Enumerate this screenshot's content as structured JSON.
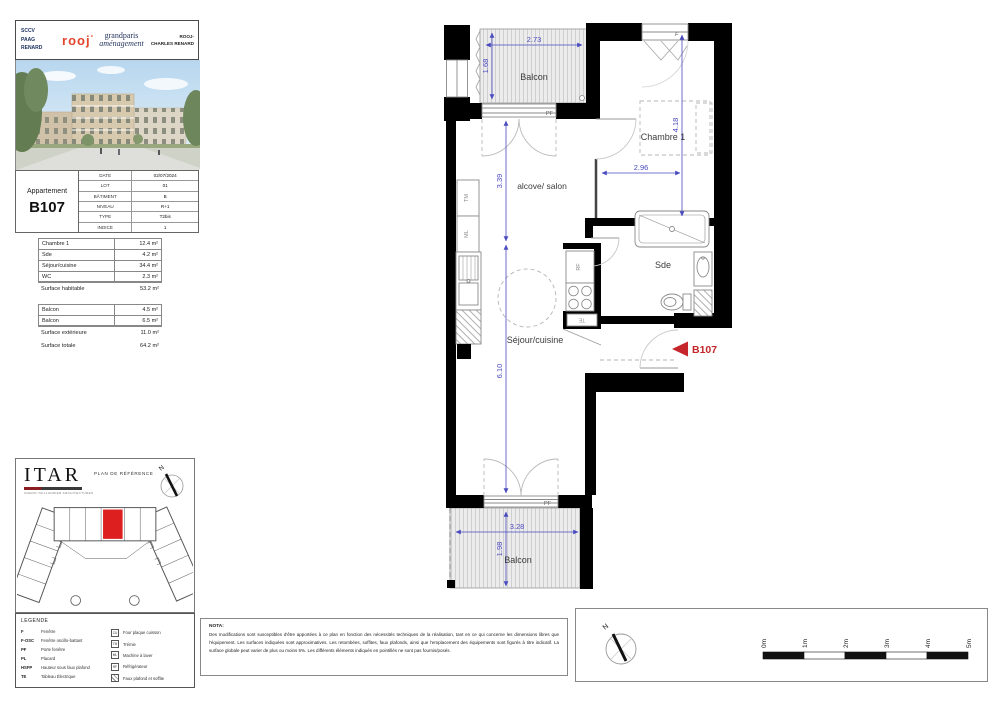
{
  "header": {
    "owner": [
      "SCCV",
      "PAAG",
      "RENARD"
    ],
    "logo_rooj": "rooj",
    "logo_grandparis": [
      "grandparis",
      "aménagement"
    ],
    "project": [
      "ROOJ-",
      "CHARLES RENARD"
    ]
  },
  "apartment": {
    "label": "Appartement",
    "number": "B107",
    "info": [
      {
        "key": "DATE",
        "value": "02/07/2024"
      },
      {
        "key": "LOT",
        "value": "01"
      },
      {
        "key": "BÂTIMENT",
        "value": "B"
      },
      {
        "key": "NIVEAU",
        "value": "R+1"
      },
      {
        "key": "TYPE",
        "value": "T2bis"
      },
      {
        "key": "INDICE",
        "value": "1"
      }
    ]
  },
  "surfaces": {
    "rooms": [
      {
        "name": "Chambre 1",
        "area": "12.4 m²"
      },
      {
        "name": "Sde",
        "area": "4.2 m²"
      },
      {
        "name": "Séjour/cuisine",
        "area": "34.4 m²"
      },
      {
        "name": "WC",
        "area": "2.3 m²"
      }
    ],
    "habitable": {
      "name": "Surface habitable",
      "area": "53.2 m²"
    },
    "exterior_rooms": [
      {
        "name": "Balcon",
        "area": "4.5 m²"
      },
      {
        "name": "Balcon",
        "area": "6.5 m²"
      }
    ],
    "exterior_total": {
      "name": "Surface extérieure",
      "area": "11.0 m²"
    },
    "total": {
      "name": "Surface totale",
      "area": "64.2 m²"
    }
  },
  "architect": {
    "name": "ITAR",
    "subtitle": "INGRID TAILLANDIER ARCHITECTURES",
    "plan_label": "PLAN DE RÉFÉRENCE",
    "north_label": "N"
  },
  "legend": {
    "title": "LEGENDE",
    "abbreviations": [
      {
        "abbr": "F",
        "label": "Fenêtre"
      },
      {
        "abbr": "F-OSC",
        "label": "Fenêtre oscillo-battant"
      },
      {
        "abbr": "PF",
        "label": "Porte fenêtre"
      },
      {
        "abbr": "PL",
        "label": "Placard"
      },
      {
        "abbr": "HSFP",
        "label": "Hauteur sous faux plafond"
      },
      {
        "abbr": "TE",
        "label": "Tableau Électrique"
      }
    ],
    "symbols": [
      {
        "abbr": "CU",
        "label": "Four plaque cuisson"
      },
      {
        "abbr": "TM",
        "label": "Trémie"
      },
      {
        "abbr": "ML",
        "label": "Machine à laver"
      },
      {
        "abbr": "RF",
        "label": "Réfrigérateur"
      }
    ],
    "symbol_hatch": {
      "label": "Faux plafond et soffite"
    }
  },
  "nota": {
    "title": "NOTA:",
    "text": "Des modifications sont susceptibles d'être apportées à ce plan en fonction des nécessités techniques de la réalisation, tant en ce qui concerne les dimensions libres que l'équipement. Les surfaces indiquées sont approximatives. Les retombées, soffites, faux plafonds, ainsi que l'emplacement des équipements sont figurés à titre indicatif. La surface globale peut varier de plus ou moins 5%. Les différents éléments indiqués en pointillés ne sont pas fournis/posés."
  },
  "plan": {
    "unit": "B107",
    "rooms": {
      "balcon_top": "Balcon",
      "chambre": "Chambre 1",
      "alcove": "alcove/ salon",
      "sde": "Sde",
      "sejour": "Séjour/cuisine",
      "balcon_bottom": "Balcon"
    },
    "dimensions": {
      "balcon_top_w": "2.73",
      "balcon_top_h": "1.68",
      "alcove_h": "3.39",
      "sejour_h": "6.10",
      "chambre_h": "4.18",
      "chambre_w": "2.96",
      "balcon_bottom_w": "3.28",
      "balcon_bottom_h": "1.98"
    },
    "tags": {
      "pf_top": "PF",
      "pf_bottom": "PF",
      "window_f": "F",
      "tm": "TM",
      "ml": "ML",
      "rf": "RF",
      "te": "TE"
    },
    "colors": {
      "dimension": "#4A4AC0",
      "unit_marker": "#C4262B",
      "wall": "#000000"
    }
  },
  "scalebar": {
    "labels": [
      "0m",
      "1m",
      "2m",
      "3m",
      "4m",
      "5m"
    ],
    "north_label": "N"
  }
}
